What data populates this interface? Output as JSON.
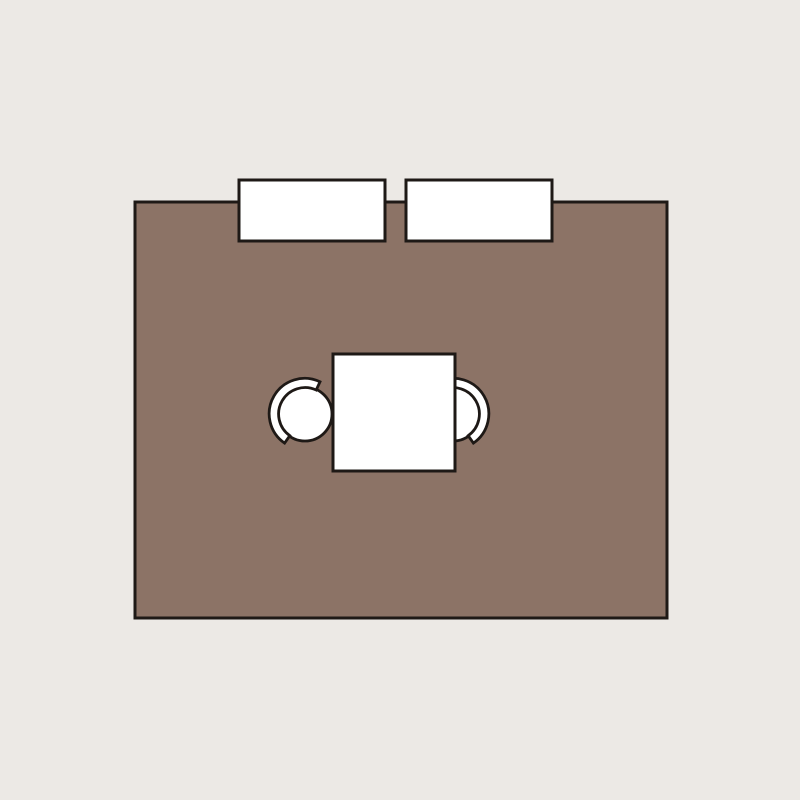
{
  "scene": {
    "type": "floor-plan",
    "elements": {
      "room": {
        "name": "room-rug",
        "shape": "rectangle"
      },
      "cabinet_left": {
        "name": "cabinet-left",
        "shape": "rectangle"
      },
      "cabinet_right": {
        "name": "cabinet-right",
        "shape": "rectangle"
      },
      "table": {
        "name": "dining-table",
        "shape": "square"
      },
      "chair_left": {
        "name": "chair-left",
        "shape": "round-chair-with-backrest",
        "position": "pulled-out-left-of-table"
      },
      "chair_right": {
        "name": "chair-right",
        "shape": "round-chair-with-backrest",
        "position": "tucked-under-right-of-table"
      }
    }
  },
  "colors": {
    "background": "#ece9e5",
    "room": "#8c7366",
    "furniture": "#ffffff",
    "outline": "#1e1916"
  }
}
